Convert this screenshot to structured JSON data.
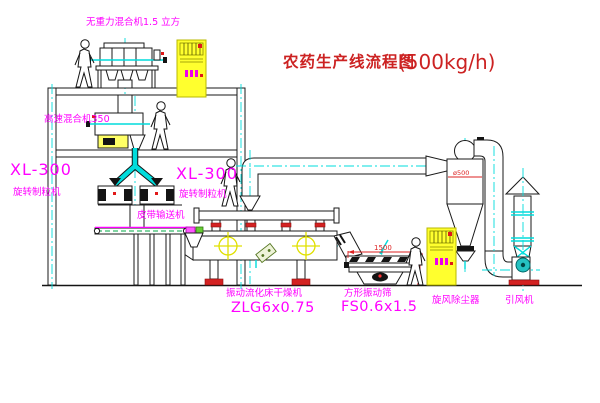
{
  "title": {
    "text": "农药生产线流程图",
    "capacity": "(500kg/h)"
  },
  "equipment": {
    "top_mixer": {
      "label": "无重力混合机1.5 立方"
    },
    "high_speed_mixer": {
      "label": "高速混合机350"
    },
    "granulator_left": {
      "model": "XL-300",
      "name": "旋转制粒机"
    },
    "granulator_right": {
      "model": "XL-300",
      "name": "旋转制粒机"
    },
    "belt_conveyor": {
      "name": "皮带输送机"
    },
    "fluid_bed_dryer": {
      "name": "振动流化床干燥机",
      "model": "ZLG6x0.75"
    },
    "square_sieve": {
      "name": "方形振动筛",
      "model": "FS0.6x1.5"
    },
    "cyclone": {
      "name": "旋风除尘器",
      "dimension": "ø500"
    },
    "induced_draft_fan": {
      "name": "引风机"
    }
  },
  "dimensions": {
    "sieve_width": "1500"
  },
  "colors": {
    "label_magenta": "#ff00ff",
    "title_red": "#cc2222",
    "dimension_red": "#dd2222",
    "centerline_cyan": "#00dcdc",
    "cabinet_yellow": "#ffff2e",
    "fan_teal": "#25c2c2"
  }
}
